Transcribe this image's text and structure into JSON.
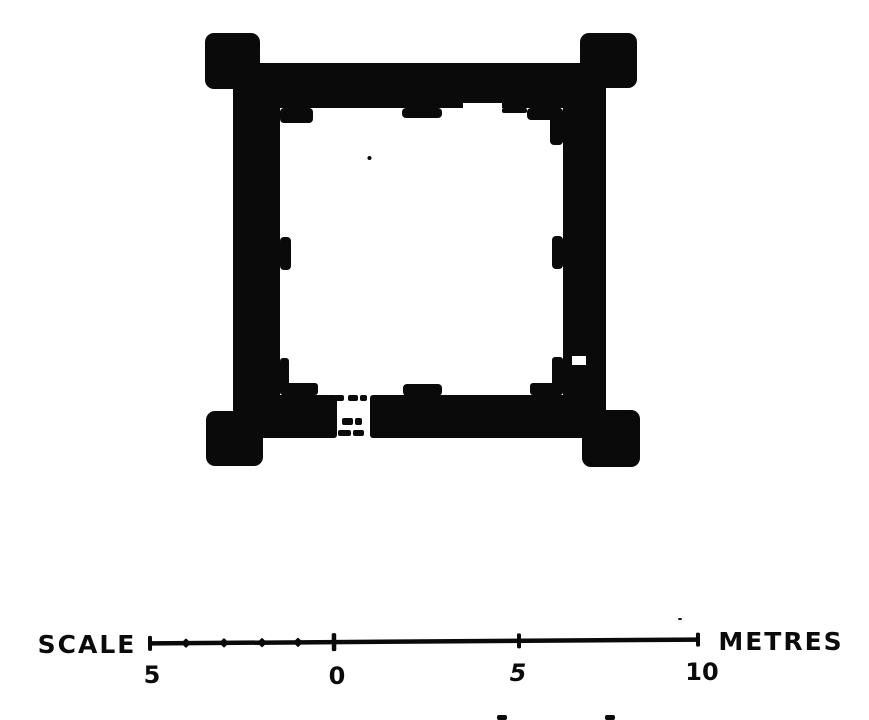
{
  "colors": {
    "ink": "#0a0a0a",
    "paper": "#ffffff"
  },
  "scale_bar": {
    "label_left": "SCALE",
    "label_right": "METRES",
    "line": {
      "x1": 150,
      "x2": 700,
      "y": 641.5,
      "thickness": 4.5
    },
    "slope_deg": -0.4,
    "ticks": [
      {
        "x": 150,
        "h": 15,
        "w": 4,
        "shape": "bar"
      },
      {
        "x": 186,
        "h": 7,
        "w": 7,
        "shape": "diamond"
      },
      {
        "x": 224,
        "h": 7,
        "w": 7,
        "shape": "diamond"
      },
      {
        "x": 262,
        "h": 7,
        "w": 7,
        "shape": "diamond"
      },
      {
        "x": 298,
        "h": 7,
        "w": 7,
        "shape": "diamond"
      },
      {
        "x": 334,
        "h": 18,
        "w": 4.5,
        "shape": "bar"
      },
      {
        "x": 519,
        "h": 15,
        "w": 4,
        "shape": "bar"
      },
      {
        "x": 698,
        "h": 14,
        "w": 4,
        "shape": "bar"
      }
    ],
    "tick_labels": [
      {
        "text": "5",
        "x": 152,
        "y": 683,
        "italic": false
      },
      {
        "text": "0",
        "x": 337,
        "y": 684,
        "italic": false
      },
      {
        "text": "5",
        "x": 518,
        "y": 681,
        "italic": true
      },
      {
        "text": "10",
        "x": 702,
        "y": 680,
        "italic": false
      }
    ]
  },
  "plan": {
    "walls": [
      {
        "name": "wall-north",
        "x": 233,
        "y": 63,
        "w": 373,
        "h": 45,
        "rx": 4
      },
      {
        "name": "wall-west",
        "x": 233,
        "y": 63,
        "w": 47,
        "h": 375,
        "rx": 4
      },
      {
        "name": "wall-east",
        "x": 563,
        "y": 63,
        "w": 43,
        "h": 375,
        "rx": 4
      },
      {
        "name": "wall-south-left",
        "x": 233,
        "y": 395,
        "w": 104,
        "h": 43,
        "rx": 3
      },
      {
        "name": "wall-south-right",
        "x": 370,
        "y": 395,
        "w": 236,
        "h": 43,
        "rx": 3
      }
    ],
    "towers": [
      {
        "name": "corner-tower-nw",
        "x": 205,
        "y": 33,
        "w": 55,
        "h": 56,
        "rx": 9
      },
      {
        "name": "corner-tower-ne",
        "x": 580,
        "y": 33,
        "w": 57,
        "h": 55,
        "rx": 9
      },
      {
        "name": "corner-tower-sw",
        "x": 206,
        "y": 411,
        "w": 57,
        "h": 55,
        "rx": 9
      },
      {
        "name": "corner-tower-se",
        "x": 582,
        "y": 410,
        "w": 58,
        "h": 57,
        "rx": 9
      }
    ],
    "pilasters": [
      {
        "name": "pilaster-nw-corner",
        "x": 280,
        "y": 108,
        "w": 33,
        "h": 15,
        "rx": 4
      },
      {
        "name": "pilaster-north-center",
        "x": 402,
        "y": 108,
        "w": 40,
        "h": 10,
        "rx": 4
      },
      {
        "name": "pilaster-north-right",
        "x": 502,
        "y": 108,
        "w": 25,
        "h": 5,
        "rx": 2
      },
      {
        "name": "pilaster-ne-step-1",
        "x": 527,
        "y": 108,
        "w": 36,
        "h": 12,
        "rx": 4
      },
      {
        "name": "pilaster-ne-step-2",
        "x": 550,
        "y": 108,
        "w": 13,
        "h": 37,
        "rx": 4
      },
      {
        "name": "pilaster-west-mid",
        "x": 280,
        "y": 237,
        "w": 11,
        "h": 33,
        "rx": 4
      },
      {
        "name": "pilaster-east-mid",
        "x": 552,
        "y": 236,
        "w": 11,
        "h": 33,
        "rx": 4
      },
      {
        "name": "pilaster-sw-step-1",
        "x": 280,
        "y": 358,
        "w": 9,
        "h": 37,
        "rx": 3
      },
      {
        "name": "pilaster-sw-step-2",
        "x": 280,
        "y": 383,
        "w": 38,
        "h": 12,
        "rx": 3
      },
      {
        "name": "pilaster-south-center",
        "x": 403,
        "y": 384,
        "w": 39,
        "h": 12,
        "rx": 4
      },
      {
        "name": "pilaster-se-step-1",
        "x": 552,
        "y": 357,
        "w": 11,
        "h": 38,
        "rx": 3
      },
      {
        "name": "pilaster-se-step-2",
        "x": 530,
        "y": 383,
        "w": 33,
        "h": 12,
        "rx": 3
      }
    ],
    "white_notches": [
      {
        "name": "notch-north-wall",
        "x": 463,
        "y": 103,
        "w": 39,
        "h": 6
      },
      {
        "name": "notch-east-wall",
        "x": 572,
        "y": 356,
        "w": 14,
        "h": 9
      }
    ],
    "entrance": {
      "dash_rows": [
        {
          "y": 395,
          "h": 6,
          "dashes": [
            [
              334,
              10
            ],
            [
              348,
              10
            ],
            [
              360,
              7
            ]
          ]
        },
        {
          "y": 418,
          "h": 7,
          "dashes": [
            [
              342,
              11
            ],
            [
              355,
              7
            ]
          ]
        },
        {
          "y": 430,
          "h": 6,
          "dashes": [
            [
              338,
              13
            ],
            [
              353,
              11
            ]
          ]
        }
      ]
    },
    "interior_dot": {
      "x": 369.5,
      "y": 158,
      "r": 2
    },
    "specks": [
      {
        "x": 678,
        "y": 618,
        "w": 4,
        "h": 2
      },
      {
        "x": 497,
        "y": 715,
        "w": 10,
        "h": 5
      },
      {
        "x": 605,
        "y": 715,
        "w": 10,
        "h": 5
      }
    ]
  }
}
